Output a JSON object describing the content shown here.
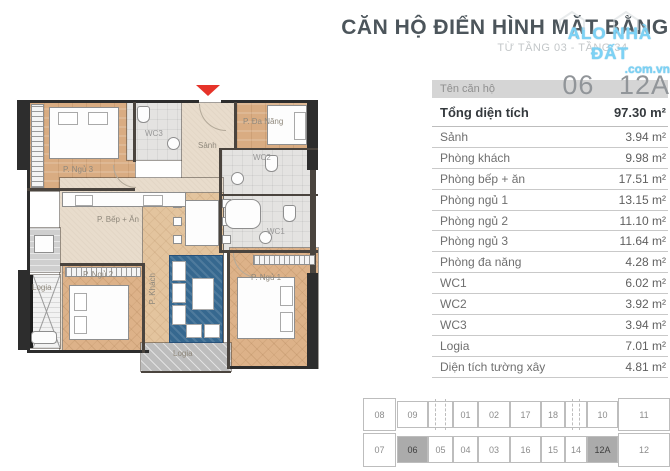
{
  "header": {
    "title": "CĂN HỘ ĐIỂN HÌNH MẶT BẰNG",
    "subtitle": "TỪ TẦNG 03 - TẦNG 34",
    "watermark_line1": "ALO NHÀ ĐẤT",
    "watermark_line2": ".com.vn"
  },
  "unit_info": {
    "name_label": "Tên căn hộ",
    "unit_numbers": [
      "06",
      "12A"
    ],
    "total_label": "Tổng diện tích",
    "total_value": "97.30 m²",
    "rows": [
      {
        "label": "Sảnh",
        "value": "3.94 m²"
      },
      {
        "label": "Phòng khách",
        "value": "9.98 m²"
      },
      {
        "label": "Phòng bếp + ăn",
        "value": "17.51 m²"
      },
      {
        "label": "Phòng ngủ 1",
        "value": "13.15 m²"
      },
      {
        "label": "Phòng ngủ 2",
        "value": "11.10 m²"
      },
      {
        "label": "Phòng ngủ 3",
        "value": "11.64 m²"
      },
      {
        "label": "Phòng đa năng",
        "value": "4.28 m²"
      },
      {
        "label": "WC1",
        "value": "6.02 m²"
      },
      {
        "label": "WC2",
        "value": "3.92 m²"
      },
      {
        "label": "WC3",
        "value": "3.94 m²"
      },
      {
        "label": "Logia",
        "value": "7.01 m²"
      },
      {
        "label": "Diện tích tường xây",
        "value": "4.81 m²"
      }
    ]
  },
  "floor_plan": {
    "rooms": {
      "bedroom3": "P. Ngủ 3",
      "wc3": "WC3",
      "hall": "Sảnh",
      "multi": "P. Đa Năng",
      "wc2": "WC2",
      "wc1": "WC1",
      "kitchen": "P. Bếp + Ăn",
      "bedroom2": "P. Ngủ 2",
      "living": "P. Khách",
      "bedroom1": "P. Ngủ 1",
      "logia_left": "Logia",
      "logia_bottom": "Logia"
    }
  },
  "key_plan": {
    "top_row": [
      "08",
      "09",
      null,
      "01",
      "02",
      "17",
      "18",
      null,
      "10",
      "11"
    ],
    "bottom_row": [
      "07",
      "06",
      "05",
      "04",
      "03",
      "16",
      "15",
      "14",
      "12A",
      "12"
    ],
    "highlighted_units": [
      "06",
      "12A"
    ]
  },
  "colors": {
    "entrance_arrow_red": "#e63329",
    "watermark_blue": "#7dd2f5",
    "highlight_gray": "#ababab",
    "header_strip_gray": "#d5d5d5",
    "title_gray": "#4c555b"
  }
}
